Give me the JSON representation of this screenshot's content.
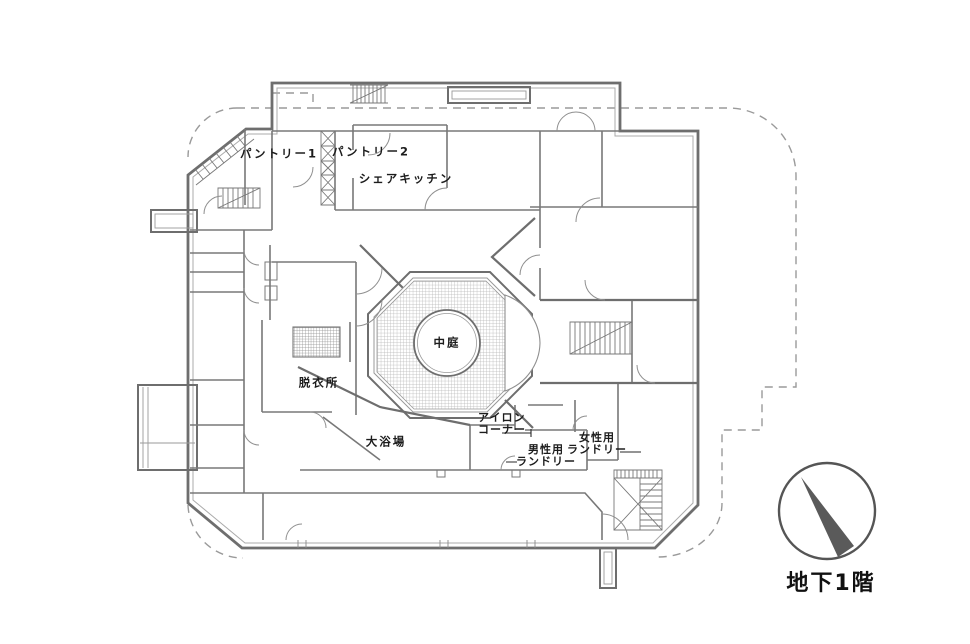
{
  "floor_plan": {
    "floor_label": "地下1階",
    "rooms": {
      "pantry1": "パントリー1",
      "pantry2": "パントリー2",
      "share_kitchen": "シェアキッチン",
      "courtyard": "中庭",
      "dressing_room": "脱衣所",
      "large_bath": "大浴場",
      "iron_corner_line1": "アイロン",
      "iron_corner_line2": "コーナー",
      "mens_laundry_line1": "男性用",
      "mens_laundry_line2": "ランドリー",
      "womens_laundry_line1": "女性用",
      "womens_laundry_line2": "ランドリー"
    },
    "compass": {
      "type": "north-arrow"
    },
    "colors": {
      "wall": "#6e6e6e",
      "inner_wall": "#787878",
      "dashed_boundary": "#9a9a9a",
      "hatch": "#b3b3b3",
      "text": "#1c1c1c",
      "compass_fill": "#5a5a5a",
      "background": "#ffffff"
    }
  }
}
